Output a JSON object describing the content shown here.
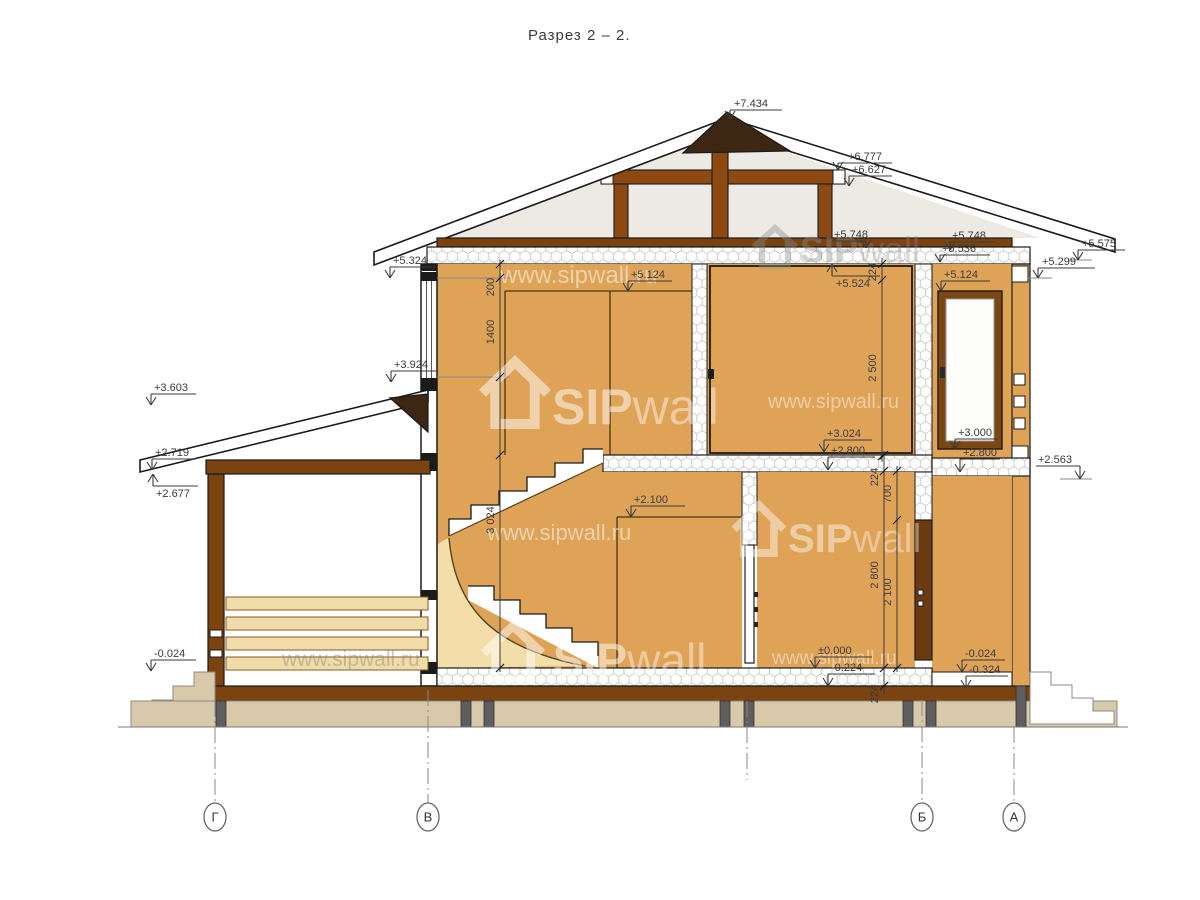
{
  "title": "Разрез 2 – 2.",
  "watermark": {
    "brand_bold": "SIP",
    "brand_light": "wall",
    "url": "www.sipwall.ru"
  },
  "colors": {
    "sip_panel_orange": "#DFA358",
    "timber_brown": "#8C4A12",
    "base_wood_brown": "#7A430F",
    "roof_cap_dark": "#3D2712",
    "window_frame": "#7B4714",
    "door_dark": "#6B3A10",
    "stair_fill_pale": "#F3DDA9",
    "foundation_tan": "#D8C9AB",
    "plank_tan": "#F0DCA8",
    "attic_bg": "#EDEAE4",
    "pier_gray": "#5E5E5E"
  },
  "axes": {
    "bubbles": [
      {
        "label": "Г",
        "x": 215,
        "y1": 701
      },
      {
        "label": "В",
        "x": 428,
        "y1": 690
      },
      {
        "label": "Б",
        "x": 922,
        "y1": 700
      },
      {
        "label": "А",
        "x": 1014,
        "y1": 727
      }
    ],
    "stub": {
      "x": 747,
      "y1": 701,
      "y2": 780
    },
    "bubble_cy": 817
  },
  "elevation_marks": [
    {
      "t": "+7.434",
      "ax": 730,
      "ay": 119,
      "sy": 110,
      "sx2": 782,
      "tx": 734,
      "ty": 107
    },
    {
      "t": "+6.777",
      "ax": 838,
      "ay": 170,
      "sy": 163,
      "sx2": 892,
      "tx": 848,
      "ty": 160
    },
    {
      "t": "+6.627",
      "ax": 849,
      "ay": 186,
      "sy": 176,
      "sx2": 892,
      "tx": 852,
      "ty": 173
    },
    {
      "t": "+5.748",
      "ax": 866,
      "ay": 248,
      "sy": 241,
      "sx2": 832,
      "tx": 834,
      "ty": 238
    },
    {
      "t": "+5.748",
      "ax": 950,
      "ay": 250,
      "sy": 242,
      "sx2": 996,
      "tx": 952,
      "ty": 239
    },
    {
      "t": "+5.536",
      "ax": 940,
      "ay": 262,
      "sy": 255,
      "sx2": 990,
      "tx": 942,
      "ty": 252
    },
    {
      "t": "+5.575",
      "ax": 1078,
      "ay": 260,
      "sy": 250,
      "sx2": 1125,
      "tx": 1082,
      "ty": 247
    },
    {
      "t": "+5.299",
      "ax": 1038,
      "ay": 278,
      "sy": 268,
      "sx2": 1095,
      "tx": 1042,
      "ty": 265
    },
    {
      "t": "+5.324",
      "ax": 390,
      "ay": 278,
      "sy": 267,
      "sx2": 436,
      "tx": 393,
      "ty": 264
    },
    {
      "t": "+5.124",
      "ax": 628,
      "ay": 291,
      "sy": 281,
      "sx2": 672,
      "tx": 631,
      "ty": 278
    },
    {
      "t": "+5.124",
      "ax": 941,
      "ay": 291,
      "sy": 281,
      "sx2": 990,
      "tx": 944,
      "ty": 278
    },
    {
      "t": "+5.524",
      "ax": 832,
      "ay": 264,
      "up": true,
      "sy": 276,
      "sx2": 880,
      "tx": 836,
      "ty": 287
    },
    {
      "t": "+3.924",
      "ax": 391,
      "ay": 382,
      "sy": 371,
      "sx2": 437,
      "tx": 394,
      "ty": 368
    },
    {
      "t": "+3.603",
      "ax": 151,
      "ay": 405,
      "sy": 394,
      "sx2": 196,
      "tx": 154,
      "ty": 391
    },
    {
      "t": "+2.719",
      "ax": 152,
      "ay": 470,
      "sy": 459,
      "sx2": 196,
      "tx": 155,
      "ty": 456
    },
    {
      "t": "+2.677",
      "ax": 153,
      "ay": 474,
      "up": true,
      "sy": 486,
      "sx2": 198,
      "tx": 156,
      "ty": 497
    },
    {
      "t": "+2.563",
      "ax": 1080,
      "ay": 479,
      "sy": 466,
      "sx2": 1036,
      "tx": 1038,
      "ty": 463
    },
    {
      "t": "+3.024",
      "ax": 824,
      "ay": 452,
      "sy": 440,
      "sx2": 872,
      "tx": 827,
      "ty": 437
    },
    {
      "t": "+2.800",
      "ax": 828,
      "ay": 470,
      "sy": 457,
      "sx2": 875,
      "tx": 831,
      "ty": 454
    },
    {
      "t": "+3.000",
      "ax": 955,
      "ay": 449,
      "sy": 439,
      "sx2": 998,
      "tx": 958,
      "ty": 436
    },
    {
      "t": "+2.800",
      "ax": 960,
      "ay": 472,
      "sy": 459,
      "sx2": 1000,
      "tx": 963,
      "ty": 456
    },
    {
      "t": "+2.100",
      "ax": 631,
      "ay": 517,
      "sy": 506,
      "sx2": 685,
      "tx": 634,
      "ty": 503
    },
    {
      "t": "±0.000",
      "ax": 815,
      "ay": 668,
      "sy": 657,
      "sx2": 872,
      "tx": 818,
      "ty": 654
    },
    {
      "t": "-0.224",
      "ax": 828,
      "ay": 686,
      "sy": 674,
      "sx2": 875,
      "tx": 831,
      "ty": 671
    },
    {
      "t": "-0.024",
      "ax": 151,
      "ay": 671,
      "sy": 660,
      "sx2": 196,
      "tx": 154,
      "ty": 657
    },
    {
      "t": "-0.024",
      "ax": 962,
      "ay": 672,
      "sy": 660,
      "sx2": 1005,
      "tx": 965,
      "ty": 657
    },
    {
      "t": "-0.324",
      "ax": 966,
      "ay": 688,
      "sy": 676,
      "sx2": 1008,
      "tx": 969,
      "ty": 673
    }
  ],
  "dimensions": [
    {
      "x": 500,
      "y1": 260,
      "y2": 672,
      "ticks": [
        264,
        278,
        377,
        455,
        668
      ],
      "labels": [
        {
          "t": "200",
          "cy": 287
        },
        {
          "t": "1400",
          "cy": 332
        },
        {
          "t": "3 024",
          "cy": 520
        }
      ]
    },
    {
      "x": 882,
      "y1": 258,
      "y2": 462,
      "ticks": [
        264,
        280,
        456
      ],
      "labels": [
        {
          "t": "224",
          "cy": 272
        },
        {
          "t": "2 500",
          "cy": 368
        }
      ]
    },
    {
      "x": 884,
      "y1": 451,
      "y2": 694,
      "ticks": [
        455,
        471,
        668,
        686
      ],
      "labels": [
        {
          "t": "224",
          "cy": 477
        },
        {
          "t": "2 800",
          "cy": 575
        },
        {
          "t": "224",
          "cy": 694
        }
      ]
    },
    {
      "x": 897,
      "y1": 466,
      "y2": 672,
      "ticks": [
        471,
        520,
        668
      ],
      "labels": [
        {
          "t": "700",
          "cy": 494
        },
        {
          "t": "2 100",
          "cy": 592
        }
      ]
    }
  ],
  "watermarks": [
    {
      "kind": "url",
      "x": 500,
      "y": 283,
      "size": 24,
      "fill": "rgba(255,255,255,0.50)"
    },
    {
      "kind": "brand",
      "x": 552,
      "y": 424,
      "size": 50,
      "fill": "rgba(255,255,255,0.50)",
      "icon": {
        "x": 486,
        "y": 362,
        "w": 58,
        "h": 62
      }
    },
    {
      "kind": "url",
      "x": 768,
      "y": 408,
      "size": 20,
      "fill": "rgba(255,255,255,0.45)"
    },
    {
      "kind": "url",
      "x": 487,
      "y": 540,
      "size": 22,
      "fill": "rgba(255,255,255,0.50)"
    },
    {
      "kind": "brand",
      "x": 788,
      "y": 552,
      "size": 40,
      "fill": "rgba(255,255,255,0.45)",
      "icon": {
        "x": 737,
        "y": 505,
        "w": 44,
        "h": 48
      }
    },
    {
      "kind": "brand",
      "x": 553,
      "y": 676,
      "size": 46,
      "fill": "rgba(255,255,255,0.50)",
      "icon": {
        "x": 487,
        "y": 626,
        "w": 52,
        "h": 54
      }
    },
    {
      "kind": "url",
      "x": 282,
      "y": 666,
      "size": 21,
      "fill": "rgba(130,125,115,0.40)"
    },
    {
      "kind": "url",
      "x": 772,
      "y": 664,
      "size": 19,
      "fill": "rgba(255,255,255,0.45)"
    },
    {
      "kind": "brand",
      "x": 800,
      "y": 262,
      "size": 36,
      "fill": "rgba(140,140,140,0.40)",
      "icon": {
        "x": 756,
        "y": 228,
        "w": 38,
        "h": 38
      }
    }
  ]
}
